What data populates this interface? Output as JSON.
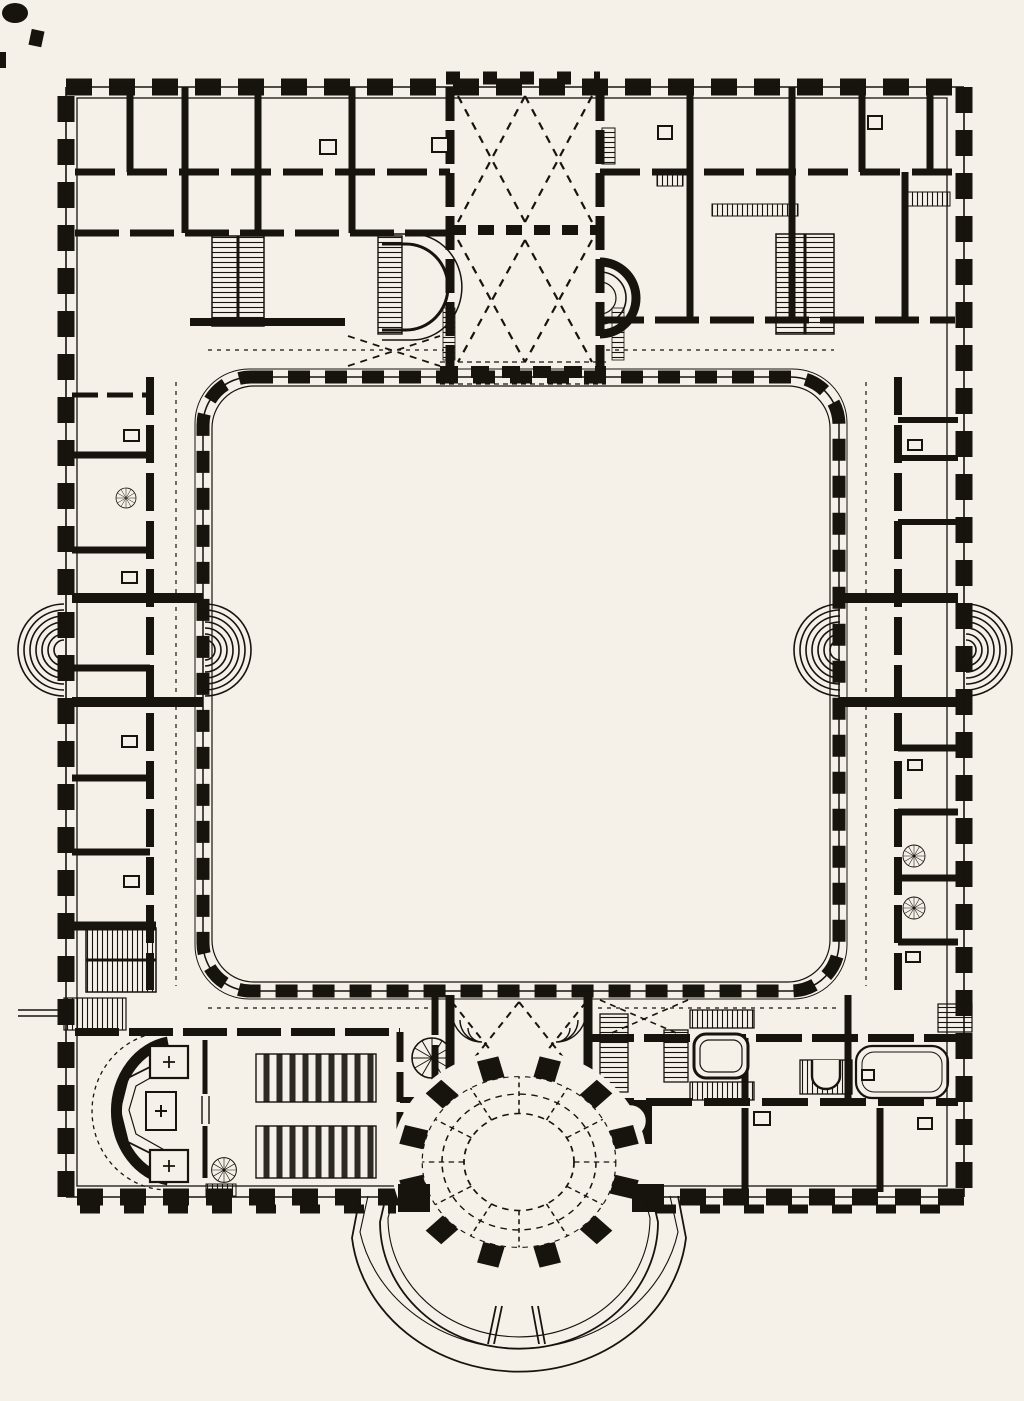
{
  "canvas": {
    "width": 1024,
    "height": 1401
  },
  "colors": {
    "paper": "#f5f1e8",
    "ink": "#17130d"
  },
  "drawing": {
    "type": "architectural-floor-plan",
    "style": "black-ink-engraving-scan",
    "features": {
      "building": "rectangular-palace-block",
      "courtyard": "large-central-courtyard-rounded-corners",
      "north_wing": "double-room-range-with-grand-vaulted-hall",
      "grand_hall": "two-bay-hall-with-x-vault-lines-and-east-apse",
      "west_wing": "single-room-range-with-courtyard-gallery",
      "east_wing": "single-room-range-with-courtyard-gallery",
      "south_wing": "range-with-chapel-vestibule-and-oval-hall",
      "chapel": "west-apse-two-altars-two-pew-blocks",
      "oval_hall": "pier-ring-oval-salon-projecting-south",
      "terrace": "curved-double-line-garden-steps",
      "ramps": "four-semicircular-ramp-bulges-mid-wings",
      "staircases": "hatched-tread-stairs-in-all-wings"
    }
  }
}
